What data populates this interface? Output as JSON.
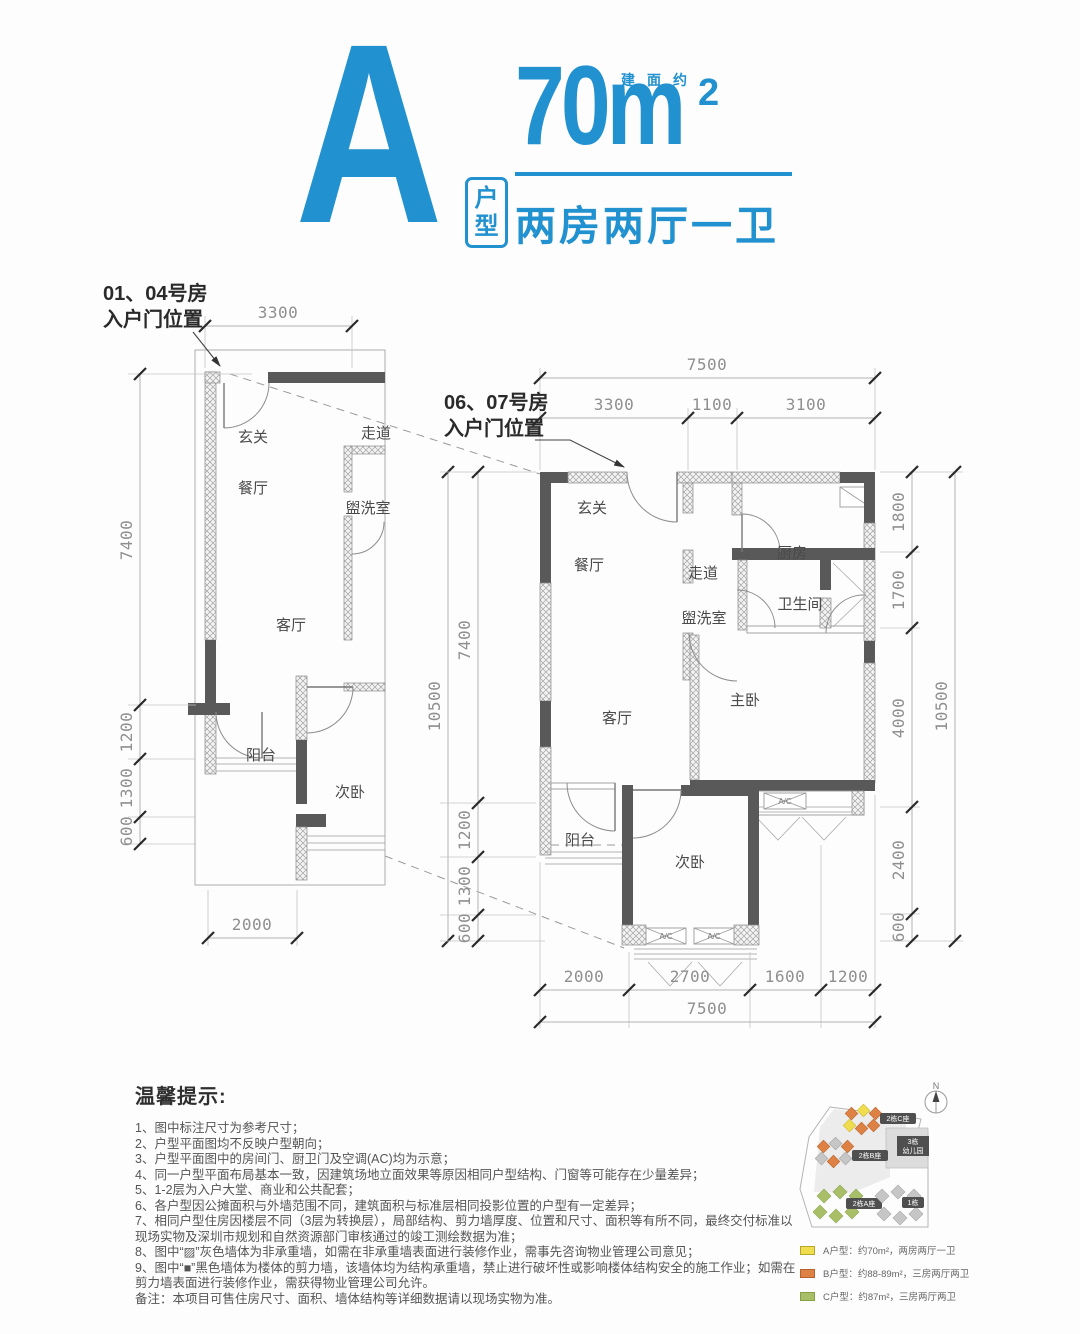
{
  "colors": {
    "accent": "#2191d0",
    "wall_dark": "#595959",
    "dim_text": "#8f8f8f"
  },
  "header": {
    "letter": "A",
    "type_char_1": "户",
    "type_char_2": "型",
    "area_note": "建面约",
    "area_value": "70m",
    "area_sup": "2",
    "subtitle": "两房两厅一卫"
  },
  "callout_left": {
    "line1": "01、04号房",
    "line2": "入户门位置"
  },
  "callout_right": {
    "line1": "06、07号房",
    "line2": "入户门位置"
  },
  "plan_left": {
    "rooms": {
      "entry": "玄关",
      "corridor": "走道",
      "dining": "餐厅",
      "wash": "盥洗室",
      "living": "客厅",
      "balcony": "阳台",
      "bedroom2": "次卧"
    },
    "dims": {
      "top": "3300",
      "left_total": "7400",
      "left_1200": "1200",
      "left_1300": "1300",
      "left_600": "600",
      "bottom": "2000"
    }
  },
  "plan_right": {
    "rooms": {
      "entry": "玄关",
      "corridor": "走道",
      "kitchen": "厨房",
      "dining": "餐厅",
      "wash": "盥洗室",
      "bath": "卫生间",
      "living": "客厅",
      "master": "主卧",
      "balcony": "阳台",
      "bedroom2": "次卧"
    },
    "ac_label": "A/C",
    "dims": {
      "top_total": "7500",
      "top_3300": "3300",
      "top_1100": "1100",
      "top_3100": "3100",
      "left_total": "10500",
      "left_7400": "7400",
      "left_1200": "1200",
      "left_1300": "1300",
      "left_600": "600",
      "right_total": "10500",
      "right_1800": "1800",
      "right_1700": "1700",
      "right_4000": "4000",
      "right_2400": "2400",
      "right_600": "600",
      "bottom_total": "7500",
      "bottom_2000": "2000",
      "bottom_2700": "2700",
      "bottom_1600": "1600",
      "bottom_1200": "1200"
    }
  },
  "notes": {
    "title": "温馨提示:",
    "items": [
      "1、图中标注尺寸为参考尺寸；",
      "2、户型平面图均不反映户型朝向；",
      "3、户型平面图中的房间门、厨卫门及空调(AC)均为示意；",
      "4、同一户型平面布局基本一致，因建筑场地立面效果等原因相同户型结构、门窗等可能存在少量差异；",
      "5、1-2层为入户大堂、商业和公共配套；",
      "6、各户型因公摊面积与外墙范围不同，建筑面积与标准层相同投影位置的户型有一定差异；",
      "7、相同户型住房因楼层不同（3层为转换层），局部结构、剪力墙厚度、位置和尺寸、面积等有所不同，最终交付标准以现场实物及深圳市规划和自然资源部门审核通过的竣工测绘数据为准；",
      "8、图中“▨”灰色墙体为非承重墙，如需在非承重墙表面进行装修作业，需事先咨询物业管理公司意见；",
      "9、图中“■”黑色墙体为楼体的剪力墙，该墙体均为结构承重墙，禁止进行破坏性或影响楼体结构安全的施工作业；如需在剪力墙表面进行装修作业，需获得物业管理公司允许。"
    ],
    "remark": "备注：本项目可售住房尺寸、面积、墙体结构等详细数据请以现场实物为准。"
  },
  "siteplan": {
    "north": "N",
    "badge_c": "2栋C座",
    "badge_b": "2栋B座",
    "badge_a": "2栋A座",
    "badge_1": "1栋",
    "kg_line1": "3栋",
    "kg_line2": "幼儿园",
    "legend": [
      {
        "color": "#efdd4d",
        "text": "A户型：约70m²，两房两厅一卫"
      },
      {
        "color": "#dd8144",
        "text": "B户型：约88-89m²，三房两厅两卫"
      },
      {
        "color": "#a9bf67",
        "text": "C户型：约87m²，三房两厅两卫"
      }
    ]
  }
}
